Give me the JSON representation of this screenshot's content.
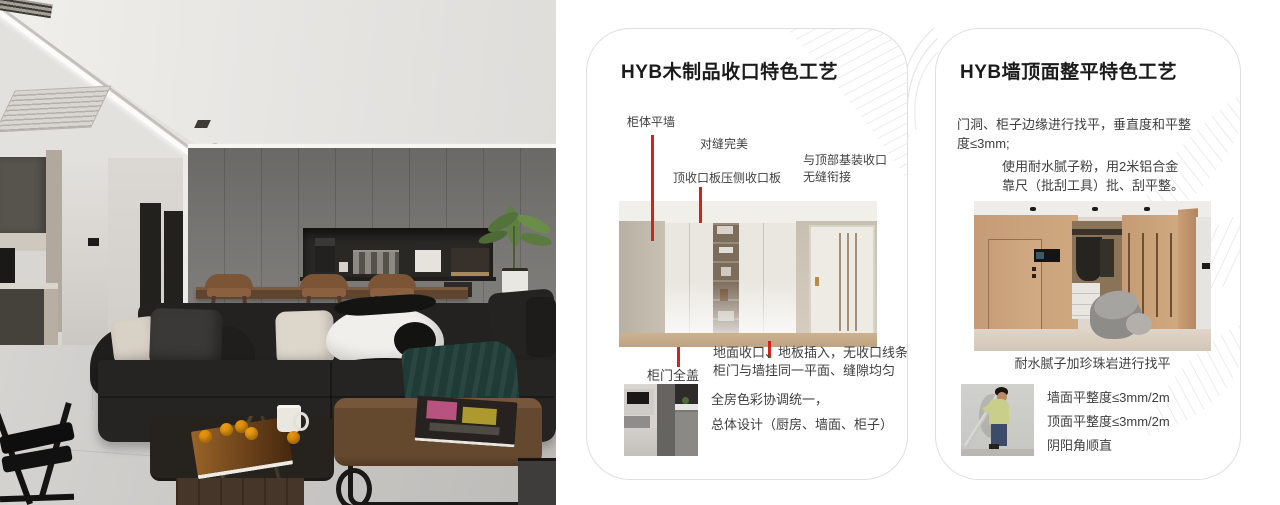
{
  "colors": {
    "accent_red": "#d0241b",
    "card_border": "#e0dfdd",
    "title_text": "#1b1b1b",
    "body_text": "#3f3f3f"
  },
  "card1": {
    "title": "HYB木制品收口特色工艺",
    "label_cabinet_wall": "柜体平墙",
    "label_seam": "对缝完美",
    "label_top_panel": "顶收口板压侧收口板",
    "label_top_joint_1": "与顶部基装收口",
    "label_top_joint_2": "无缝衔接",
    "label_door_cover": "柜门全盖",
    "note_floor_1": "地面收口、地板插入，无收口线条",
    "note_floor_2": "柜门与墙挂同一平面、缝隙均匀",
    "note_color_1": "全房色彩协调统一，",
    "note_color_2": "总体设计（厨房、墙面、柜子）"
  },
  "card2": {
    "title": "HYB墙顶面整平特色工艺",
    "para_door_1": "门洞、柜子边缘进行找平，垂直度和平整",
    "para_door_2": "度≤3mm;",
    "para_putty_1": "使用耐水腻子粉，用2米铝合金",
    "para_putty_2": "靠尺（批刮工具）批、刮平整。",
    "caption_leveling": "耐水腻子加珍珠岩进行找平",
    "metrics": [
      "墙面平整度≤3mm/2m",
      "顶面平整度≤3mm/2m",
      "阴阳角顺直"
    ]
  }
}
